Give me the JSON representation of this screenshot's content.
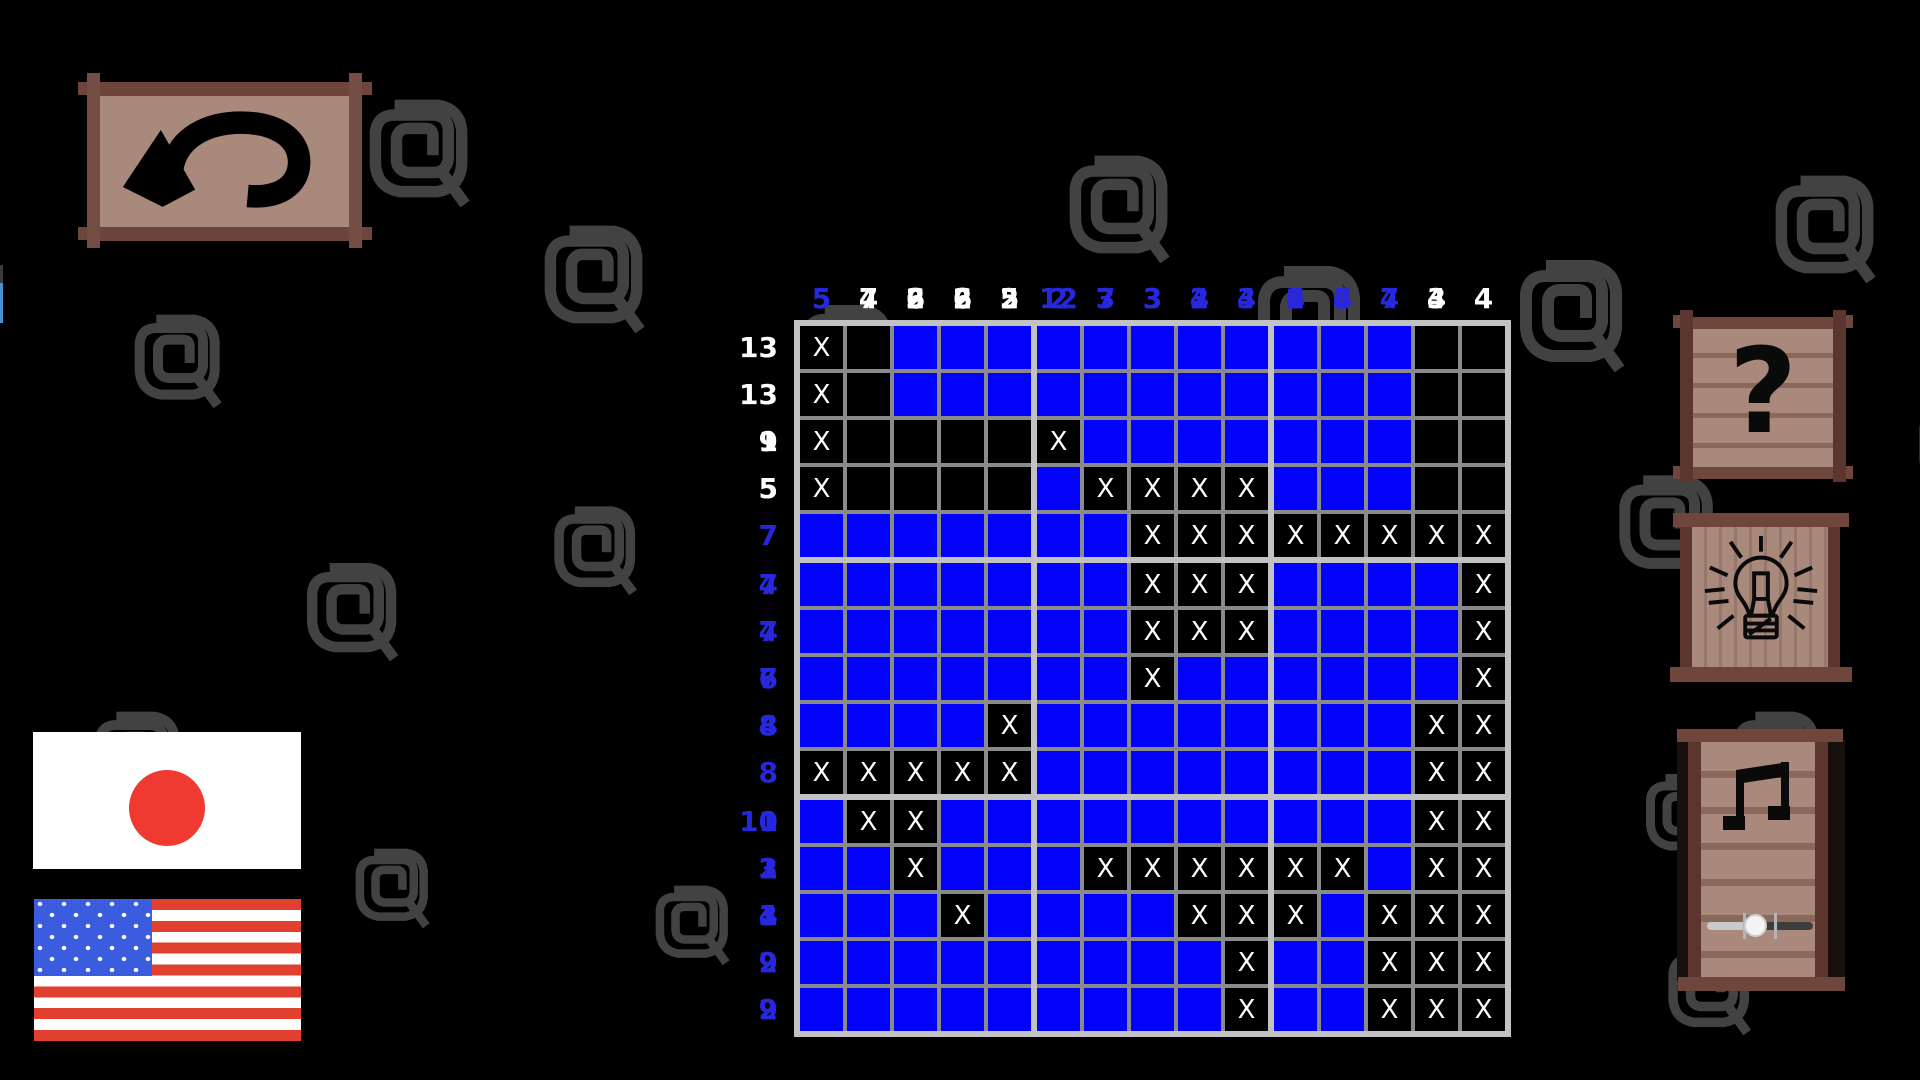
{
  "board": {
    "size": 15,
    "mark_symbol": "X",
    "cells": [
      "X.BBBBBBBBBBB..",
      "X.BBBBBBBBBBB..",
      "X....XBBBBBBB..",
      "X....BXXXXBBB..",
      "BBBBBBBXXXXXXXX",
      "BBBBBBBXXXBBBBX",
      "BBBBBBBXXXBBBBX",
      "BBBBBBBXBBBBBBX",
      "BBBBXBBBBBBBBXX",
      "XXXXXBBBBBBBBXX",
      "BXXBBBBBBBBBBXX",
      "BBXBBBXXXXXXBXX",
      "BBBXBBBBXXXBXXX",
      "BBBBBBBBBXBBXXX",
      "BBBBBBBBBXBBXXX"
    ],
    "row_clues": [
      {
        "numbers": [
          13
        ],
        "complete": false
      },
      {
        "numbers": [
          13
        ],
        "complete": false
      },
      {
        "numbers": [
          1,
          9
        ],
        "complete": false
      },
      {
        "numbers": [
          5,
          5
        ],
        "complete": false
      },
      {
        "numbers": [
          7
        ],
        "complete": true
      },
      {
        "numbers": [
          7,
          4
        ],
        "complete": true
      },
      {
        "numbers": [
          7,
          4
        ],
        "complete": true
      },
      {
        "numbers": [
          7,
          6
        ],
        "complete": true
      },
      {
        "numbers": [
          4,
          8
        ],
        "complete": true
      },
      {
        "numbers": [
          8
        ],
        "complete": true
      },
      {
        "numbers": [
          1,
          10
        ],
        "complete": true
      },
      {
        "numbers": [
          2,
          3,
          1
        ],
        "complete": true
      },
      {
        "numbers": [
          3,
          4,
          1
        ],
        "complete": true
      },
      {
        "numbers": [
          9,
          2
        ],
        "complete": true
      },
      {
        "numbers": [
          9,
          2
        ],
        "complete": true
      }
    ],
    "col_clues": [
      {
        "numbers": [
          5,
          5
        ],
        "complete": true
      },
      {
        "numbers": [
          7,
          4
        ],
        "complete": false
      },
      {
        "numbers": [
          2,
          6,
          3
        ],
        "complete": false
      },
      {
        "numbers": [
          2,
          6,
          2,
          2
        ],
        "complete": false
      },
      {
        "numbers": [
          2,
          5,
          5
        ],
        "complete": false
      },
      {
        "numbers": [
          2,
          12
        ],
        "complete": true
      },
      {
        "numbers": [
          3,
          7,
          3
        ],
        "complete": true
      },
      {
        "numbers": [
          3,
          3,
          3
        ],
        "complete": true
      },
      {
        "numbers": [
          3,
          4,
          2
        ],
        "complete": true
      },
      {
        "numbers": [
          3,
          4
        ],
        "complete": true
      },
      {
        "numbers": [
          4,
          6,
          2
        ],
        "complete": true
      },
      {
        "numbers": [
          4,
          6,
          3
        ],
        "complete": true
      },
      {
        "numbers": [
          4,
          7
        ],
        "complete": true
      },
      {
        "numbers": [
          4,
          3
        ],
        "complete": false
      },
      {
        "numbers": [
          4
        ],
        "complete": false
      }
    ],
    "colors": {
      "filled": "#0202fa",
      "empty": "#000000",
      "grid_minor": "#8a8a8a",
      "grid_major": "#c2c2c2",
      "mark": "#ffffff",
      "clue_complete": "#2727dd",
      "clue_incomplete": "#ffffff"
    }
  },
  "controls": {
    "undo": {
      "icon": "undo-arrow"
    },
    "help": {
      "icon": "question-mark",
      "glyph": "?"
    },
    "hint": {
      "icon": "lightbulb"
    },
    "music": {
      "icon": "music-note",
      "volume_percent": 45
    }
  },
  "language": {
    "options": [
      {
        "id": "japanese",
        "icon": "japan-flag"
      },
      {
        "id": "english",
        "icon": "us-flag"
      }
    ]
  },
  "decorations": {
    "spiral_color": "#424242",
    "wood": {
      "post": "#5c362e",
      "plank": "#6f463c",
      "panel": "#a8897c",
      "seam": "#8a695c",
      "undo_post": "#744d44",
      "undo_plank": "#6d453c"
    },
    "spirals": [
      [
        362,
        92,
        115
      ],
      [
        537,
        218,
        115
      ],
      [
        128,
        308,
        100
      ],
      [
        1062,
        148,
        115
      ],
      [
        795,
        298,
        105
      ],
      [
        1250,
        258,
        120
      ],
      [
        1512,
        252,
        120
      ],
      [
        1768,
        168,
        115
      ],
      [
        1612,
        468,
        110
      ],
      [
        300,
        556,
        105
      ],
      [
        548,
        500,
        95
      ],
      [
        88,
        705,
        100
      ],
      [
        350,
        843,
        85
      ],
      [
        650,
        880,
        85
      ],
      [
        1662,
        940,
        95
      ],
      [
        1727,
        705,
        100
      ],
      [
        1640,
        768,
        90
      ],
      [
        1912,
        390,
        110
      ]
    ],
    "edge_artifact_colors": [
      "#3a3a3a",
      "#4d8fd2"
    ]
  }
}
